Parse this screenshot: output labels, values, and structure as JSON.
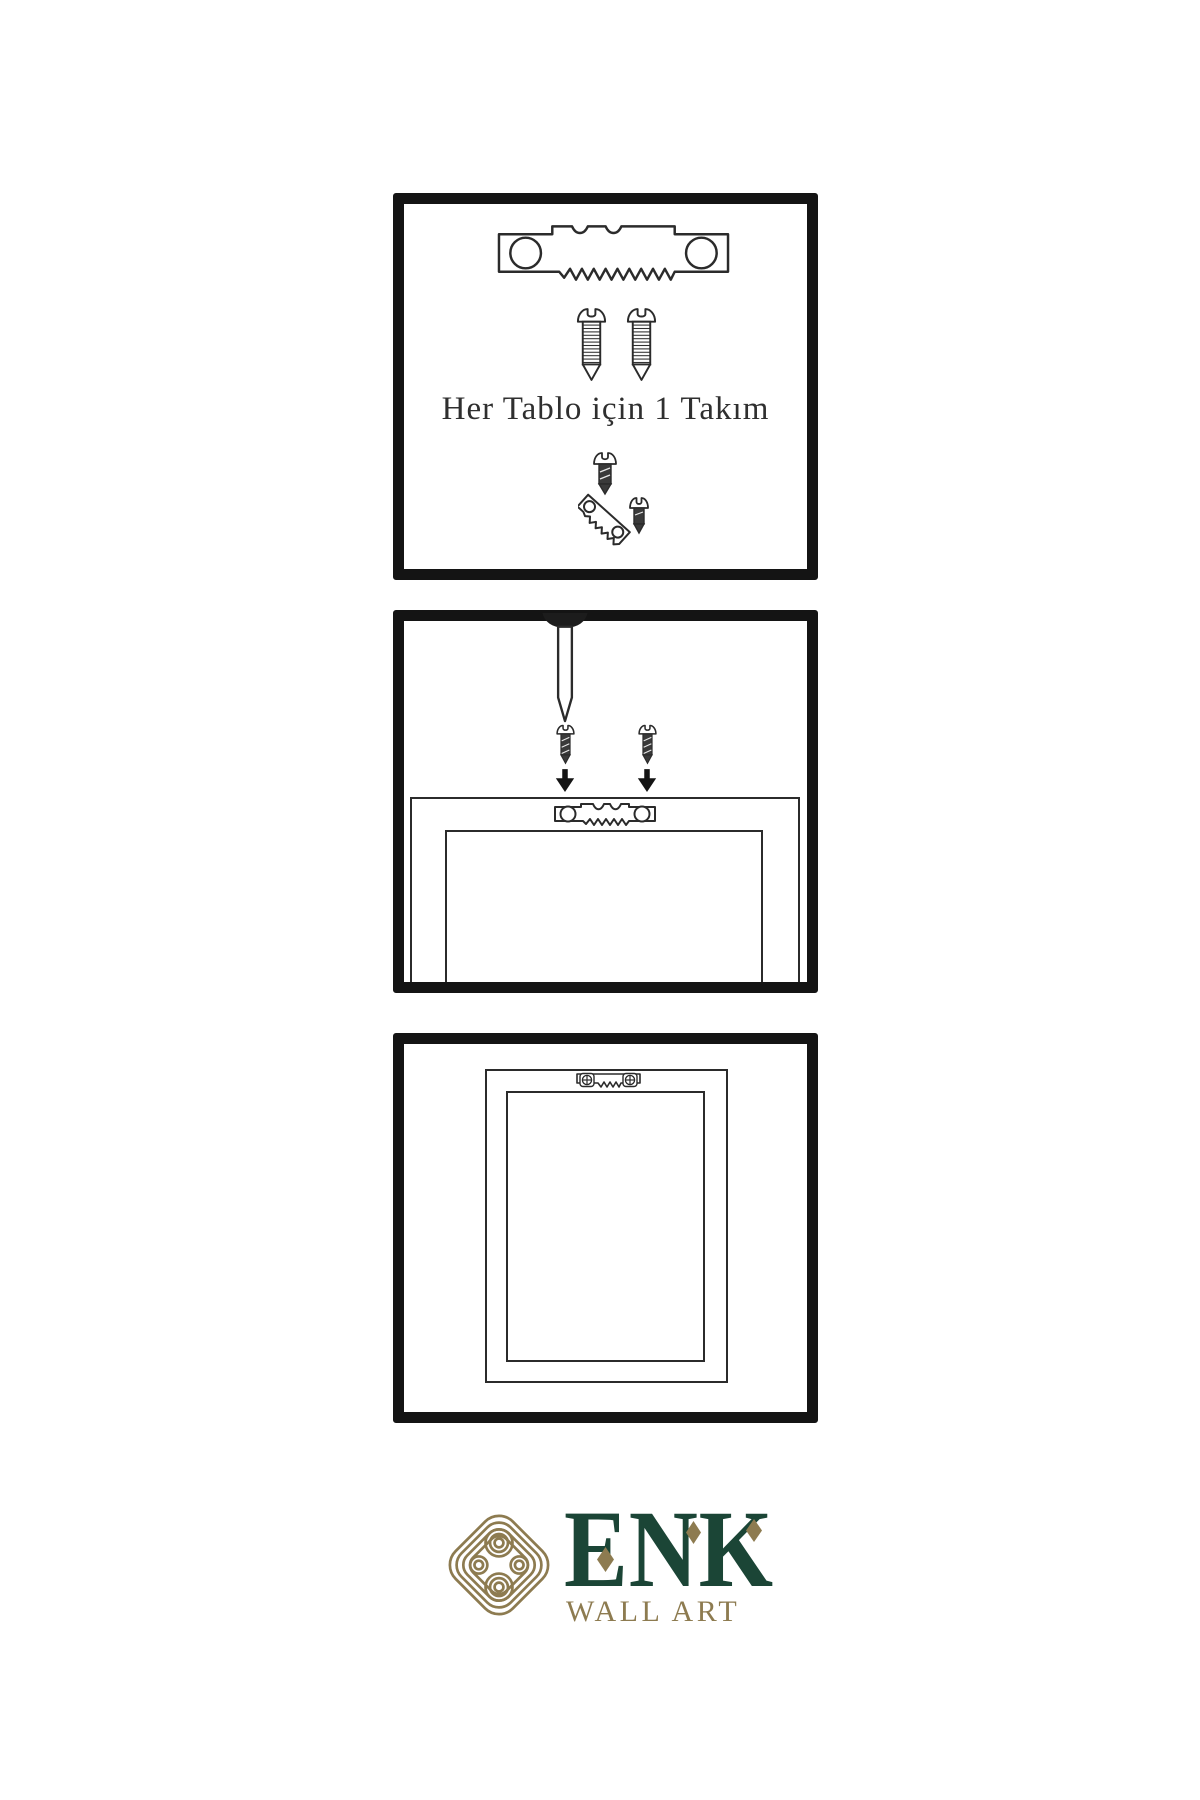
{
  "colors": {
    "background": "#ffffff",
    "ink": "#2b2b2b",
    "panel_border": "#141414",
    "solid_black": "#141414",
    "brand_green": "#1b4536",
    "brand_gold": "#8d7b50"
  },
  "steps": [
    {
      "id": "kit",
      "caption": "Her Tablo için 1 Takım",
      "icons": [
        "sawtooth-hanger-icon",
        "screw-icon",
        "screw-icon",
        "dark-screw-icon",
        "angled-sawtooth-hanger-icon",
        "dark-screw-icon"
      ]
    },
    {
      "id": "mount",
      "icons": [
        "nail-icon",
        "dark-screw-icon",
        "dark-screw-icon",
        "arrow-down-icon",
        "arrow-down-icon",
        "sawtooth-hanger-icon",
        "picture-frame-back-icon"
      ]
    },
    {
      "id": "hang",
      "icons": [
        "picture-frame-back-icon",
        "mounted-sawtooth-hanger-icon"
      ]
    }
  ],
  "brand": {
    "name": "ENK",
    "tagline": "WALL ART",
    "logo_icon": "interlaced-knot-icon",
    "diamond_accents": 3
  }
}
